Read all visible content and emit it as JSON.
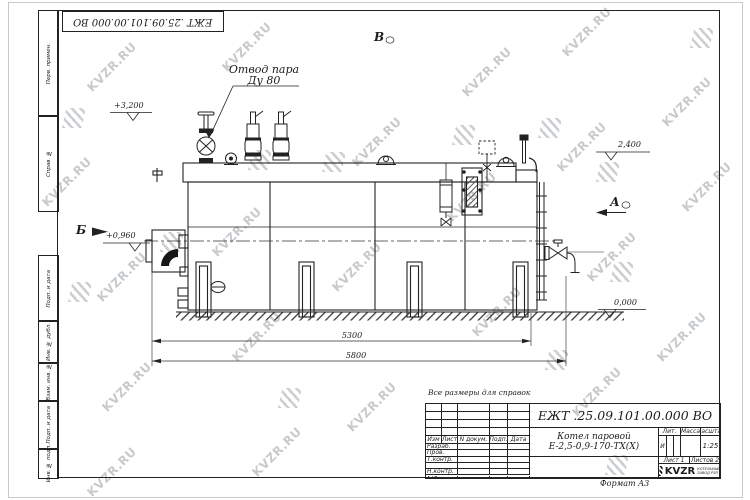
{
  "watermark": {
    "text": "KVZR.RU"
  },
  "stamp": {
    "designation_flipped": "ЕЖТ .25.09.101.00.000  ВО"
  },
  "margins": {
    "perv": "Перв. примен.",
    "sprav": "Справ. №",
    "podp_data1": "Подп. и дата",
    "inv_dubl": "Инв. № дубл.",
    "vzam_inv": "Взам. инв. №",
    "podp_data2": "Подп. и дата",
    "inv_podl": "Инв. № подл."
  },
  "drawing": {
    "steam_outlet": {
      "line1": "Отвод пара",
      "line2": "Ду 80"
    },
    "views": {
      "top": "В",
      "left": "Б",
      "right": "А"
    },
    "elevations": {
      "valve_top": "+3,200",
      "plate_right": "2,400",
      "burner_axis": "+0,960",
      "ground": "0,000"
    },
    "dims": {
      "boiler_length": "5300",
      "overall_length": "5800"
    }
  },
  "note": {
    "text": "Все размеры для справок"
  },
  "title_block": {
    "designation": "ЕЖТ .25.09.101.00.000  ВО",
    "product_line1": "Котел паровой",
    "product_line2": "Е-2,5-0,9-170-ТХ(Х)",
    "header": {
      "izm": "Изм",
      "list": "Лист",
      "doc": "N докум.",
      "podp": "Подп.",
      "date": "Дата"
    },
    "sign_rows": {
      "razrab": "Разраб.",
      "prov": "Пров.",
      "tkontr": "Т.контр.",
      "nkontr": "Н.контр.",
      "utv": "Утв."
    },
    "lit": {
      "label": "Лит.",
      "value": "И"
    },
    "mass": {
      "label": "Масса",
      "value": ""
    },
    "scale": {
      "label": "Масштаб",
      "value": "1:25"
    },
    "sheet": "Лист 1",
    "sheets": "Листов 2",
    "company": {
      "name": "KVZR",
      "sub1": "КОТЕЛЬНЫЙ",
      "sub2": "ЗАВОД РЭП"
    },
    "format": "Формат А3"
  }
}
